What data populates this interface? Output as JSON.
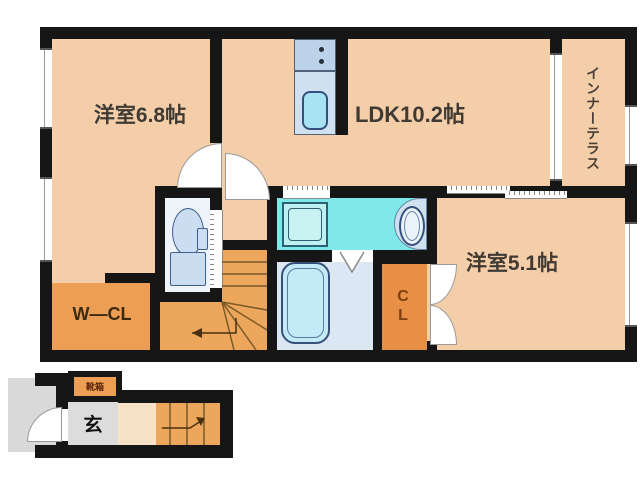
{
  "labels": {
    "room68": "洋室6.8帖",
    "ldk": "LDK10.2帖",
    "terrace": "インナーテラス",
    "room51": "洋室5.1帖",
    "wcl": "W―CL",
    "cl": "CL",
    "genkan": "玄",
    "shoebox": "靴箱"
  },
  "colors": {
    "wall": "#161616",
    "floor_peach": "#F4CDA9",
    "closet_orange": "#ED9E55",
    "cl_orange": "#E78F45",
    "stairs_orange": "#EDA75C",
    "washroom_cyan": "#7FE9E9",
    "fixture_blue": "#CBDDF1",
    "bathroom_blue": "#DCE7F4",
    "tub_blue": "#C3EAF7",
    "toilet_room_white": "#EFF4FB",
    "counter_blue": "#CFE0F0",
    "stove_blue": "#BCD2E8",
    "sink_cyan": "#A7E3F2",
    "porch_gray": "#D9D9D9",
    "entry_tile_gray": "#DCDCDC",
    "hall_cream": "#F6E2C4"
  },
  "fixtures": [
    "kitchen-counter",
    "stove-burners",
    "kitchen-sink",
    "toilet",
    "washing-machine-pan",
    "wash-basin",
    "bathtub",
    "staircase-2f",
    "staircase-1f",
    "entrance-door"
  ]
}
